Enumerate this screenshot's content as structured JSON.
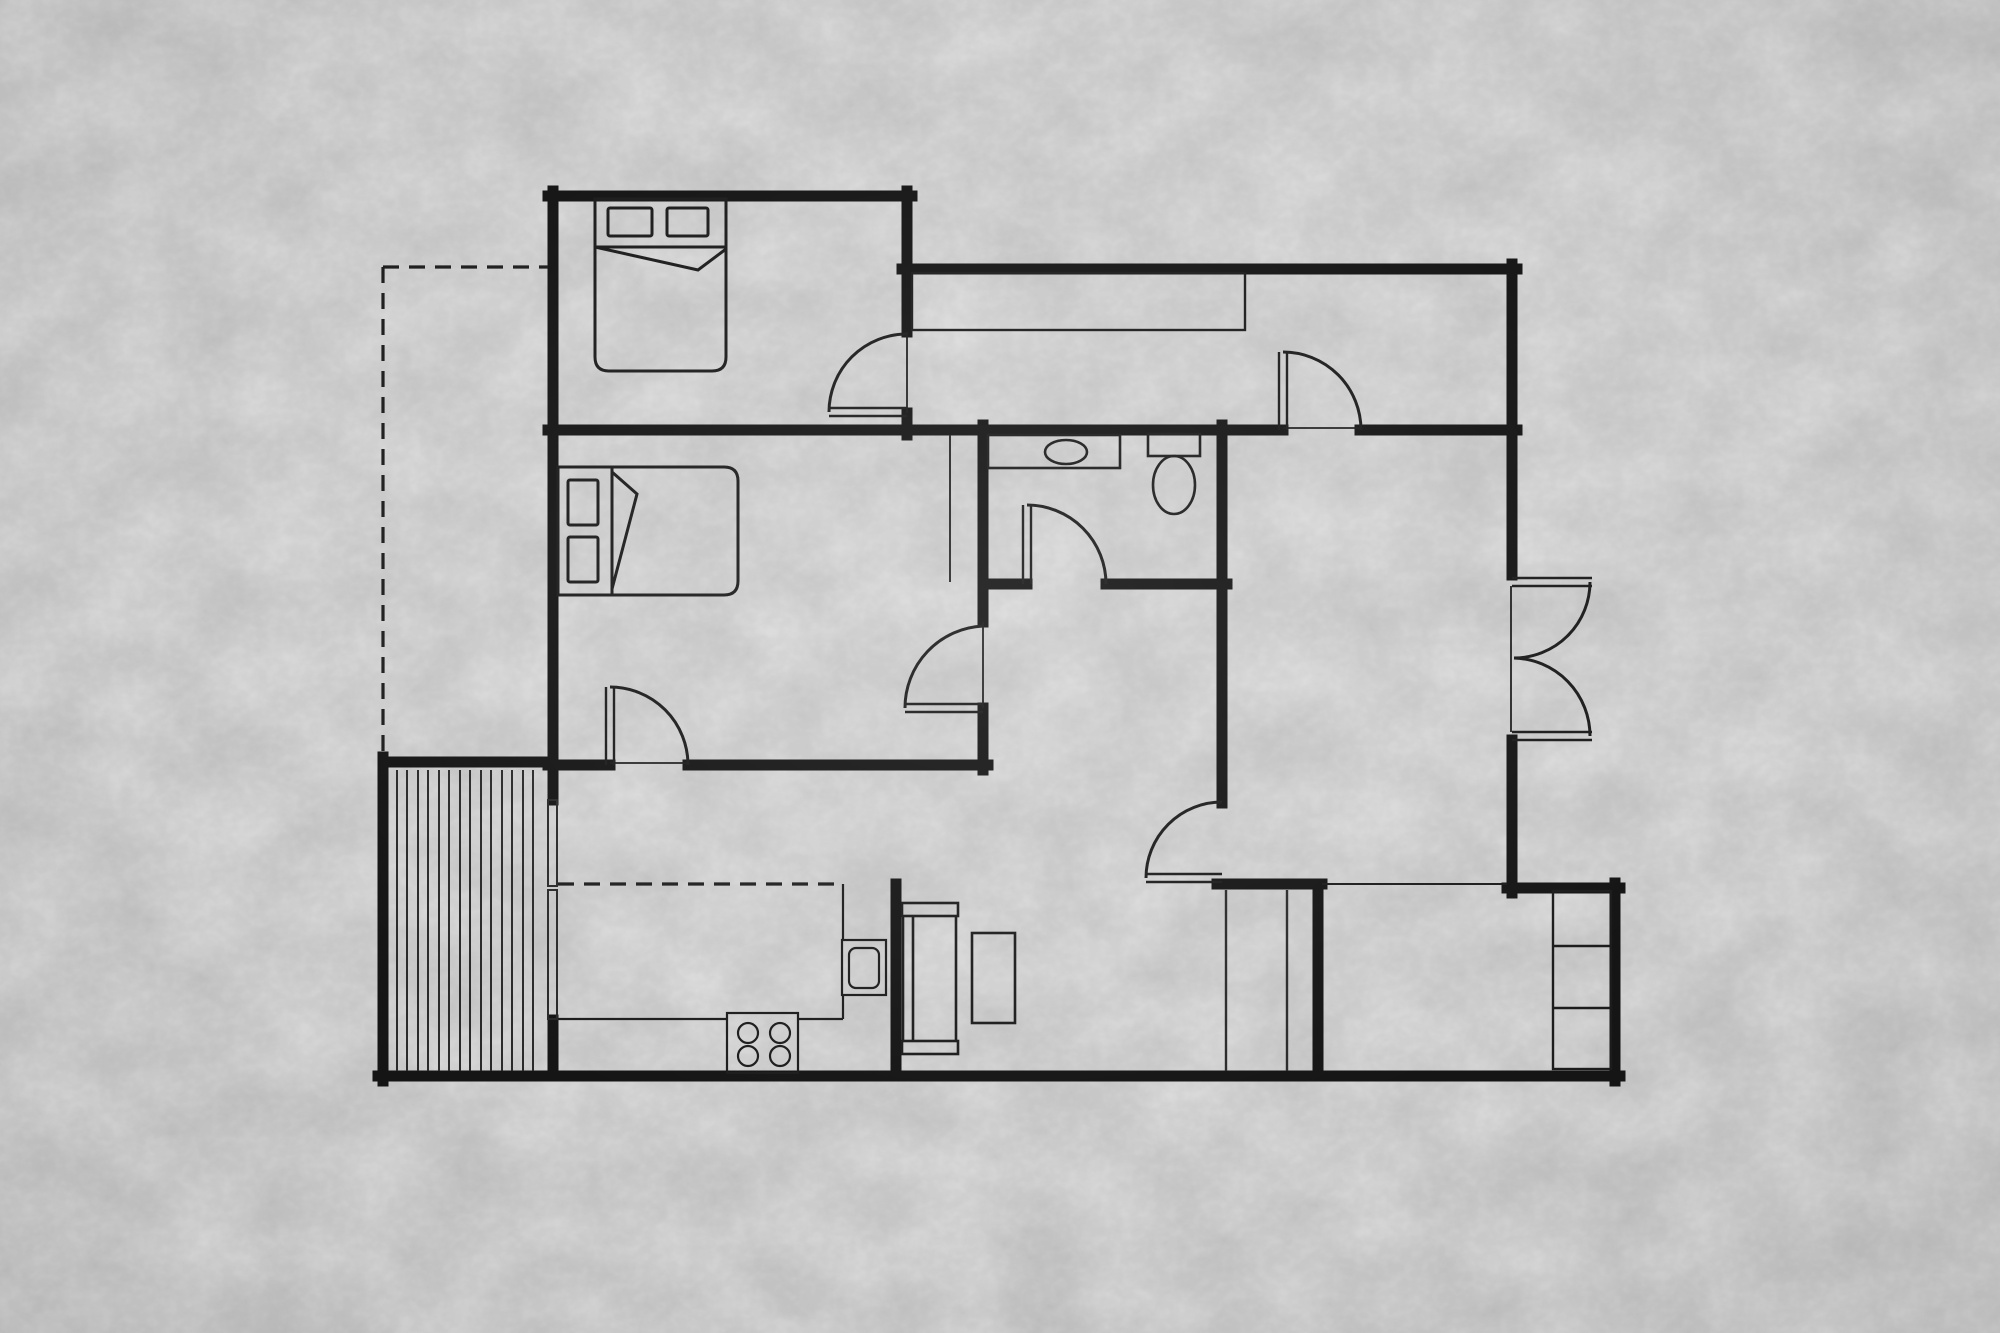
{
  "canvas": {
    "width": 2000,
    "height": 1333,
    "background_color": "#c9c9c9",
    "wall_color": "#151515",
    "thin_line_color": "#1f1f1f",
    "dash_pattern": "16 10"
  },
  "floor_plan": {
    "type": "apartment-floor-plan-top-view",
    "rooms": [
      {
        "id": "bedroom-1",
        "position": "top-left",
        "furniture": [
          "double-bed",
          "pillow",
          "pillow",
          "folded-blanket"
        ],
        "door_count": 1
      },
      {
        "id": "bedroom-2",
        "position": "middle-left",
        "furniture": [
          "double-bed",
          "pillow",
          "pillow",
          "folded-blanket",
          "wardrobe-line"
        ],
        "door_count": 2
      },
      {
        "id": "hallway",
        "position": "top-right",
        "furniture": [
          "built-in-closet"
        ],
        "door_count": 1
      },
      {
        "id": "bathroom",
        "position": "center",
        "fixtures": [
          "vanity-counter",
          "sink-basin",
          "toilet"
        ],
        "door_count": 1
      },
      {
        "id": "living-area",
        "position": "center-bottom",
        "furniture": [
          "sofa",
          "coffee-table"
        ]
      },
      {
        "id": "kitchen",
        "position": "bottom-left",
        "fixtures": [
          "counter",
          "cooktop-four-burners",
          "sink-unit"
        ],
        "openings": [
          "sliding-door-to-deck"
        ]
      },
      {
        "id": "room-right",
        "position": "right",
        "doors": [
          "hallway-door",
          "double-doors-east",
          "entry-door-southwest"
        ]
      },
      {
        "id": "storage-room",
        "position": "bottom-right",
        "fixtures": [
          "shelving-three-sections"
        ],
        "openings": [
          "wide-opening-north"
        ]
      },
      {
        "id": "deck",
        "position": "outside-bottom-left",
        "detail": "plank-decking",
        "plank_line_count": 14
      },
      {
        "id": "stair-niche",
        "position": "bottom-center-right",
        "detail": "two-thin-partition-lines"
      }
    ],
    "doors": [
      {
        "id": "door-bedroom-1",
        "swing": "into-bedroom-1"
      },
      {
        "id": "door-hallway-to-room-right",
        "swing": "into-hallway"
      },
      {
        "id": "door-bedroom-2-east",
        "swing": "into-bedroom-2"
      },
      {
        "id": "door-bedroom-2-south",
        "swing": "into-bedroom-2"
      },
      {
        "id": "door-bathroom",
        "swing": "into-bathroom"
      },
      {
        "id": "door-entry-living",
        "swing": "into-living-area"
      },
      {
        "id": "double-doors-east",
        "swing": "outward-east-pair"
      }
    ],
    "dashed_lines": [
      {
        "id": "left-boundary-outline",
        "orientation": "L-shape-top-left"
      },
      {
        "id": "kitchen-counter-dashed-line",
        "orientation": "horizontal"
      }
    ]
  }
}
